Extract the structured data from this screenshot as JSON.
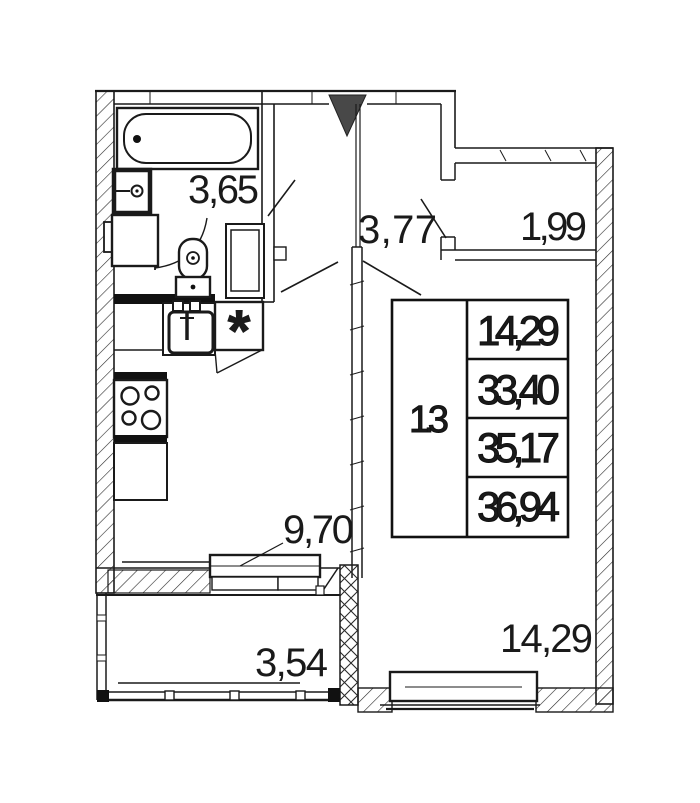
{
  "floor_plan": {
    "rooms": {
      "bathroom": {
        "area": "3,65"
      },
      "hallway": {
        "area": "3,77"
      },
      "wardrobe": {
        "area": "1,99"
      },
      "kitchen_living": {
        "area": "9,70"
      },
      "living_room": {
        "area": "14,29"
      },
      "balcony": {
        "area": "3,54"
      }
    },
    "area_table": {
      "unit_type": "1.3",
      "values": [
        "14,29",
        "33,40",
        "35,17",
        "36,94"
      ]
    },
    "markers": {
      "washer": "*"
    },
    "colors": {
      "line": "#1a1a1a",
      "wall_fill": "#111111",
      "entry_arrow": "#484848",
      "background": "#ffffff"
    }
  }
}
